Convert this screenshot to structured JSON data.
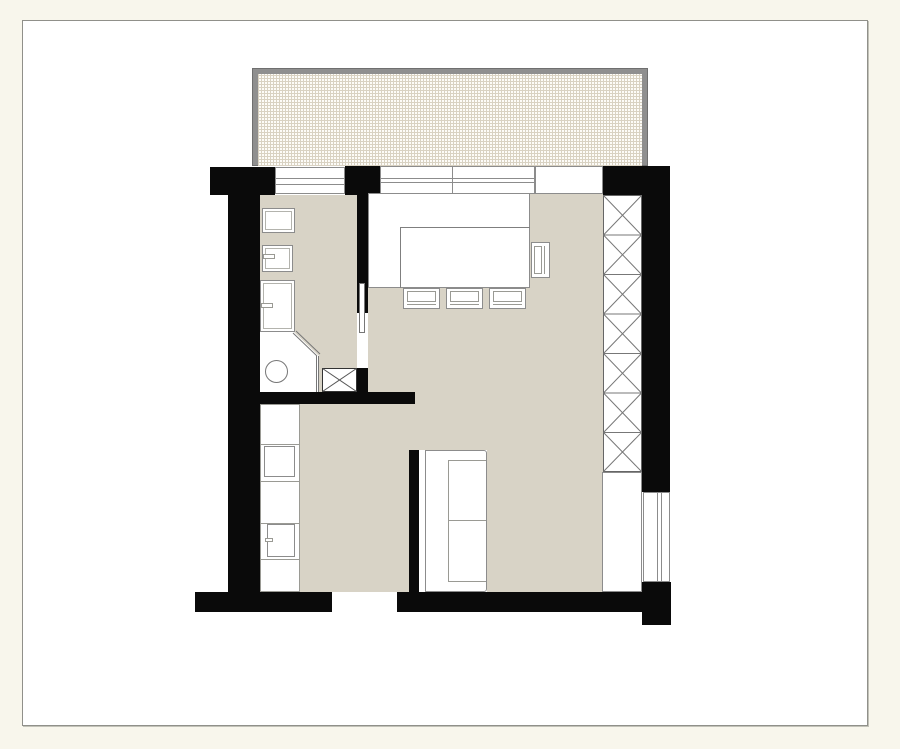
{
  "document": {
    "kind": "architectural floor plan",
    "view": "top-down 2D",
    "visible_text": "none",
    "drawing_style": "black poche walls on white paper sheet over cream background"
  },
  "colors": {
    "canvas_background": "#f8f6ec",
    "paper": "#ffffff",
    "paper_border": "#90908a",
    "wall": "#0a0a0a",
    "floor": "#d8d3c6",
    "furniture_fill": "#ffffff",
    "furniture_outline": "#8c8c8c",
    "balcony_frame": "#8f8f8f",
    "balcony_grid_line": "#d9d2c2"
  },
  "plan": {
    "balcony": {
      "position": "top, spanning full width of apartment",
      "railing": "gray frame on three sides",
      "floor_hatch": "fine square grid"
    },
    "rooms": [
      {
        "name": "bathroom",
        "position": "upper left",
        "elements": [
          "cabinet-or-washer",
          "sink with faucet",
          "shower tray with faucet",
          "toilet",
          "diagonal glass partition",
          "duct-shaft with X hatch",
          "pocket door to kitchen"
        ]
      },
      {
        "name": "kitchen-dining",
        "position": "upper center",
        "elements": [
          "counter along window wall",
          "dining table attached to counter",
          "three chairs on south side",
          "one chair on east side",
          "window with mullion",
          "balcony door opening"
        ]
      },
      {
        "name": "living-area",
        "position": "center right",
        "elements": [
          "sofa with chaise cushions against half wall",
          "tall wardrobe with X-hatched sections",
          "low cabinet below wardrobe",
          "window in right wall"
        ]
      },
      {
        "name": "lower-left-room",
        "position": "bottom left",
        "elements": [
          "counter strip along left wall",
          "appliance square",
          "appliance with door handle",
          "entrance opening in bottom wall"
        ]
      }
    ],
    "counts": {
      "wardrobe_sections": 7,
      "dining_chairs": 4,
      "top_wall_windows": 2,
      "right_wall_windows": 1,
      "wall_openings": 3
    }
  }
}
